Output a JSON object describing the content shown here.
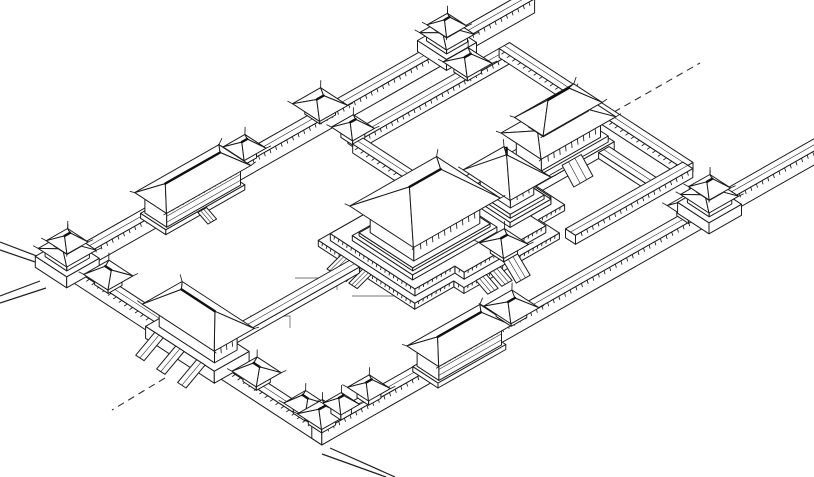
{
  "drawing": {
    "description": "axonometric ink line drawing of a walled imperial palace compound with corner towers, gate pavilions, galleries, corridors and great halls on stepped terraces",
    "ink_color": "#1b1b1b",
    "background_color": "#ffffff",
    "projection": {
      "origin_x": 57,
      "origin_y": 272,
      "ux": 0.869,
      "uy": -0.494,
      "vx": 0.838,
      "vy": 0.547
    },
    "ground_lines": [
      [
        [
          295,
          278
        ],
        [
          337,
          278
        ],
        [
          337,
          290
        ]
      ],
      [
        [
          250,
          316
        ],
        [
          290,
          316
        ],
        [
          290,
          328
        ]
      ],
      [
        [
          352,
          296
        ],
        [
          396,
          296
        ]
      ]
    ],
    "extension_lines": [
      [
        [
          42,
          258
        ],
        [
          0,
          242
        ]
      ],
      [
        [
          47,
          266
        ],
        [
          0,
          250
        ]
      ],
      [
        [
          40,
          281
        ],
        [
          0,
          296
        ]
      ],
      [
        [
          46,
          288
        ],
        [
          0,
          303
        ]
      ],
      [
        [
          330,
          448
        ],
        [
          395,
          477
        ]
      ],
      [
        [
          322,
          454
        ],
        [
          386,
          477
        ]
      ]
    ],
    "dashed_lines": [
      [
        [
          614,
          112
        ],
        [
          700,
          63
        ]
      ],
      [
        [
          165,
          378
        ],
        [
          112,
          410
        ]
      ]
    ],
    "structures": [
      {
        "id": "northwest-wall",
        "name": "northwest enclosure wall",
        "type": "wall",
        "axis": "u",
        "from": 0,
        "to": 538,
        "at": 0,
        "w": 12,
        "h": 14
      },
      {
        "id": "north-gate-tower",
        "name": "north wall gate tower",
        "type": "tower",
        "u": 443,
        "v": 6,
        "s": 24
      },
      {
        "id": "nw-gate-pavilion",
        "name": "northwest wall gate pavilion",
        "type": "pavilion",
        "u": 297,
        "v": 6,
        "s": 18,
        "h0": 14,
        "axis": "u"
      },
      {
        "id": "nw-mid-pavilion",
        "name": "northwest wall small pavilion",
        "type": "pavilion",
        "u": 210,
        "v": 6,
        "s": 14,
        "h0": 14,
        "axis": "u"
      },
      {
        "id": "west-gallery",
        "name": "two-storey gallery hall on west wall",
        "type": "gallery",
        "axis": "u",
        "from": 105,
        "to": 190,
        "at": -4,
        "w": 26
      },
      {
        "id": "west-gallery-stairs",
        "name": "gallery stairs",
        "type": "stairs",
        "from": [
          138,
          25
        ],
        "w": 10,
        "len": 12,
        "dir": "se",
        "h": 5,
        "base": 0
      },
      {
        "id": "inner-nw-corridor",
        "name": "inner courtyard northwest corridor",
        "type": "wall",
        "axis": "u",
        "from": 300,
        "to": 474,
        "at": 36,
        "w": 12,
        "h": 9
      },
      {
        "id": "corridor-corner-kiosk",
        "name": "corridor corner kiosk",
        "type": "pavilion",
        "u": 300,
        "v": 42,
        "s": 14,
        "h0": 9,
        "axis": "u"
      },
      {
        "id": "corridor-junction-pavilion",
        "name": "corridor junction pavilion",
        "type": "pavilion",
        "u": 432,
        "v": 42,
        "s": 16,
        "h0": 9,
        "axis": "u"
      },
      {
        "id": "inner-ne-corridor",
        "name": "inner courtyard northeast corridor",
        "type": "wall",
        "axis": "v",
        "from": 36,
        "to": 255,
        "at": 474,
        "w": 12,
        "h": 9
      },
      {
        "id": "inner-west-corridor",
        "name": "inner courtyard west corridor",
        "type": "wall",
        "axis": "v",
        "from": 48,
        "to": 120,
        "at": 294,
        "w": 12,
        "h": 9
      },
      {
        "id": "upper-main-hall",
        "name": "double-eaved main hall of rear court",
        "type": "hall",
        "plinths": [
          [
            368,
            458,
            146,
            190,
            0,
            8
          ],
          [
            372,
            454,
            149,
            187,
            8,
            14
          ]
        ],
        "body": [
          380,
          448,
          154,
          184,
          14,
          32
        ],
        "skirt": {
          "o": 9,
          "he": 35,
          "hr": 41,
          "ins": 10
        },
        "upperBody": [
          388,
          440,
          160,
          178,
          41,
          48
        ],
        "roof": {
          "o": 8,
          "he": 50,
          "hr": 66,
          "ins": 14,
          "axis": "u"
        }
      },
      {
        "id": "upper-hall-stairs",
        "name": "rear hall front stairs",
        "type": "stairs",
        "from": [
          398,
          190
        ],
        "w": 22,
        "len": 14,
        "dir": "se",
        "h": 14,
        "base": 0
      },
      {
        "id": "upper-hall-connector",
        "name": "raised connector walk",
        "type": "walkway",
        "axis": "v",
        "from": 190,
        "to": 249,
        "at": 440,
        "w": 12,
        "h": 6
      },
      {
        "id": "inner-se-corridor",
        "name": "inner courtyard southeast corridor",
        "type": "wall",
        "axis": "u",
        "from": 345,
        "to": 480,
        "at": 249,
        "w": 12,
        "h": 9
      },
      {
        "id": "central-terrace",
        "name": "great stepped terrace with zigzag edges",
        "type": "terrace",
        "tiers": [
          {
            "h": 6,
            "base": 0,
            "pts": [
              [
                185,
                120
              ],
              [
                300,
                120
              ],
              [
                300,
                140
              ],
              [
                370,
                140
              ],
              [
                370,
                222
              ],
              [
                340,
                222
              ],
              [
                340,
                247
              ],
              [
                230,
                247
              ],
              [
                230,
                235
              ],
              [
                185,
                235
              ]
            ],
            "skirt": [
              4,
              6,
              7,
              8,
              9
            ]
          },
          {
            "h": 13,
            "base": 6,
            "pts": [
              [
                192,
                127
              ],
              [
                306,
                127
              ],
              [
                306,
                146
              ],
              [
                362,
                146
              ],
              [
                362,
                214
              ],
              [
                332,
                214
              ],
              [
                332,
                239
              ],
              [
                238,
                239
              ],
              [
                238,
                228
              ],
              [
                192,
                228
              ]
            ],
            "skirt": [
              4,
              6,
              7,
              8,
              9
            ]
          }
        ]
      },
      {
        "id": "square-pavilion-hall",
        "name": "square pavilion hall with pyramidal roof",
        "type": "pyramid",
        "plinths": [
          [
            315,
            362,
            158,
            214,
            6,
            11
          ],
          [
            319,
            358,
            162,
            210,
            11,
            15
          ]
        ],
        "body": [
          325,
          352,
          168,
          204,
          15,
          30
        ],
        "roof": {
          "o": 10,
          "he": 33,
          "apex": [
            338,
            186,
            52
          ]
        }
      },
      {
        "id": "central-main-hall",
        "name": "great central audience hall",
        "type": "hall",
        "plinths": [
          [
            199,
            296,
            146,
            218,
            13,
            18
          ],
          [
            203,
            292,
            150,
            214,
            18,
            21
          ]
        ],
        "body": [
          210,
          286,
          156,
          208,
          21,
          44
        ],
        "roof": {
          "o": 12,
          "he": 47,
          "hr": 71,
          "ins": 20,
          "axis": "u"
        }
      },
      {
        "id": "terrace-gate-pavilion",
        "name": "terrace south gate pavilion",
        "type": "pavilion",
        "u": 280,
        "v": 243,
        "s": 16,
        "h0": 13,
        "axis": "u"
      },
      {
        "id": "terrace-stairs-1",
        "name": "terrace stairs",
        "type": "stairs",
        "from": [
          244,
          247
        ],
        "w": 12,
        "len": 14,
        "dir": "se",
        "h": 6,
        "base": 0
      },
      {
        "id": "terrace-stairs-2",
        "name": "terrace stairs",
        "type": "stairs",
        "from": [
          260,
          247
        ],
        "w": 12,
        "len": 14,
        "dir": "se",
        "h": 6,
        "base": 0
      },
      {
        "id": "terrace-gate-stairs",
        "name": "terrace gate stairs",
        "type": "stairs",
        "from": [
          272,
          251
        ],
        "w": 16,
        "len": 15,
        "dir": "se",
        "h": 13,
        "base": 0
      },
      {
        "id": "terrace-ramp-1",
        "name": "terrace west ramp",
        "type": "stairs",
        "from": [
          185,
          147
        ],
        "w": 10,
        "len": 16,
        "dir": "sw",
        "h": 6,
        "base": 0
      },
      {
        "id": "terrace-ramp-2",
        "name": "terrace west ramp",
        "type": "stairs",
        "from": [
          185,
          160
        ],
        "w": 10,
        "len": 16,
        "dir": "sw",
        "h": 6,
        "base": 0
      },
      {
        "id": "terrace-ramp-3",
        "name": "terrace west ramp",
        "type": "stairs",
        "from": [
          185,
          173
        ],
        "w": 10,
        "len": 16,
        "dir": "sw",
        "h": 6,
        "base": 0
      },
      {
        "id": "processional-walkway",
        "name": "raised processional walkway",
        "type": "walkway",
        "axis": "u",
        "from": 28,
        "to": 185,
        "at": 157,
        "w": 12,
        "h": 6
      },
      {
        "id": "southwest-wall",
        "name": "southwest enclosure wall",
        "type": "wall",
        "axis": "v",
        "from": 0,
        "to": 316,
        "at": 0,
        "w": 12,
        "h": 14
      },
      {
        "id": "west-corner-tower",
        "name": "west corner tower",
        "type": "tower",
        "u": 6,
        "v": 6,
        "s": 26
      },
      {
        "id": "sw-gate-pavilion-north",
        "name": "southwest wall north pavilion",
        "type": "pavilion",
        "u": 6,
        "v": 55,
        "s": 16,
        "h0": 14,
        "axis": "v"
      },
      {
        "id": "main-gate-hall",
        "name": "main south gate hall with three ramps",
        "type": "main-gate",
        "platform": [
          -8,
          32,
          114,
          196,
          0,
          12
        ],
        "body": [
          0,
          26,
          122,
          188,
          12,
          31
        ],
        "roof": {
          "o": 10,
          "he": 34,
          "hr": 50,
          "ins": 13,
          "axis": "v"
        },
        "ramps": [
          130,
          155,
          180
        ]
      },
      {
        "id": "sw-pavilion-mid",
        "name": "southwest wall middle pavilion",
        "type": "pavilion",
        "u": 6,
        "v": 232,
        "s": 16,
        "h0": 14,
        "axis": "v"
      },
      {
        "id": "sw-pavilion-south",
        "name": "southwest wall south pavilion",
        "type": "pavilion",
        "u": 6,
        "v": 290,
        "s": 14,
        "h0": 14,
        "axis": "v"
      },
      {
        "id": "southeast-wall",
        "name": "southeast enclosure wall",
        "type": "wall",
        "axis": "u",
        "from": 0,
        "to": 578,
        "at": 304,
        "w": 12,
        "h": 14
      },
      {
        "id": "south-corner-pavilion",
        "name": "south corner pavilion",
        "type": "pavilion",
        "u": 6,
        "v": 310,
        "s": 16,
        "h0": 14,
        "axis": "u"
      },
      {
        "id": "se-pavilion-1",
        "name": "southeast wall pavilion",
        "type": "pavilion",
        "u": 28,
        "v": 310,
        "s": 12,
        "h0": 14,
        "axis": "u"
      },
      {
        "id": "se-pavilion-2",
        "name": "southeast wall pavilion",
        "type": "pavilion",
        "u": 60,
        "v": 310,
        "s": 14,
        "h0": 14,
        "axis": "u"
      },
      {
        "id": "east-gallery",
        "name": "two-storey gallery hall on southeast wall",
        "type": "gallery",
        "axis": "u",
        "from": 128,
        "to": 200,
        "at": 297,
        "w": 26
      },
      {
        "id": "se-gate-pavilion",
        "name": "southeast wall gate pavilion",
        "type": "pavilion",
        "u": 224,
        "v": 310,
        "s": 18,
        "h0": 14,
        "axis": "u"
      },
      {
        "id": "se-small-pavilion",
        "name": "pavilion beside east gate tower",
        "type": "pavilion",
        "u": 428,
        "v": 310,
        "s": 14,
        "h0": 14,
        "axis": "u"
      },
      {
        "id": "east-gate-tower",
        "name": "east gate tower",
        "type": "tower",
        "u": 452,
        "v": 310,
        "s": 26
      }
    ]
  }
}
